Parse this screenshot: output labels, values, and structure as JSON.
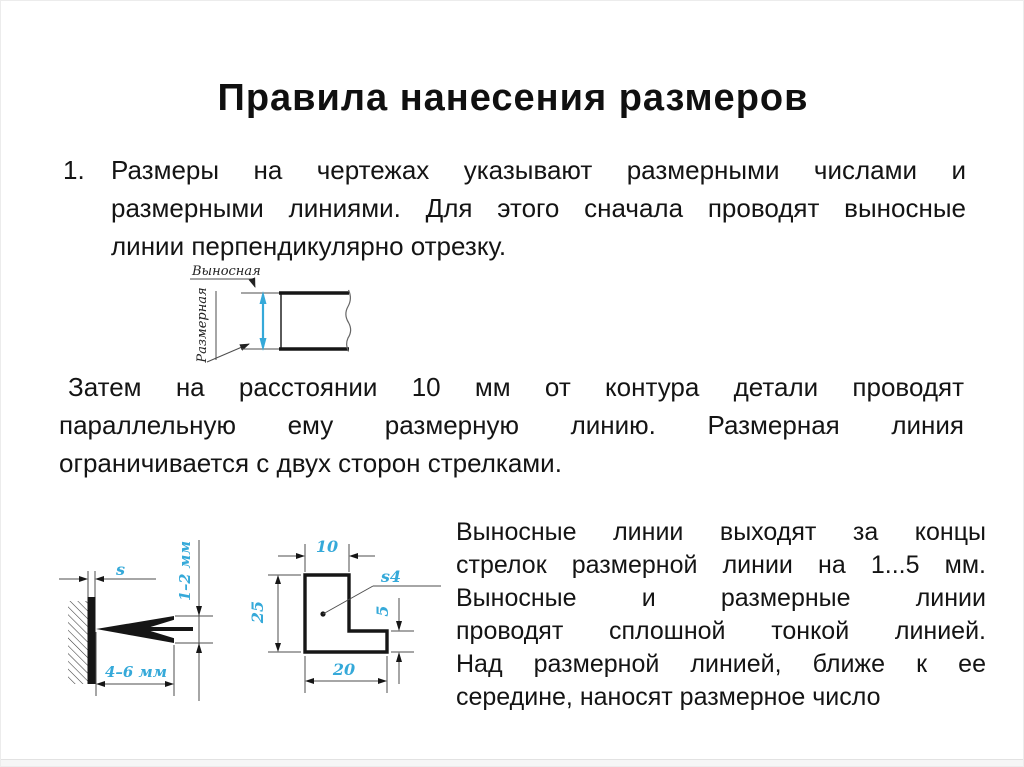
{
  "slide": {
    "title": "Правила нанесения размеров",
    "list_item": {
      "number": "1.",
      "lines": [
        "Размеры на чертежах указывают размерными числами и",
        "размерными линиями. Для этого сначала проводят выносные",
        "линии перпендикулярно отрезку."
      ]
    },
    "paragraph_middle": {
      "lines": [
        "Затем на расстоянии 10 мм от контура детали проводят",
        "параллельную ему размерную линию. Размерная линия",
        "ограничивается с двух сторон стрелками."
      ]
    },
    "paragraph_right": {
      "lines": [
        "Выносные линии выходят за концы",
        "стрелок размерной линии на 1...5 мм.",
        "Выносные и размерные линии",
        "проводят сплошной тонкой линией.",
        "Над размерной линией, ближе к ее",
        "середине, наносят размерное число"
      ]
    }
  },
  "figures": {
    "extension_dimension": {
      "label_extension": "Выносная",
      "label_dimension": "Размерная"
    },
    "arrowhead_detail": {
      "thickness_label": "s",
      "width_label": "1–2 мм",
      "length_label": "4–6 мм"
    },
    "l_part": {
      "dim_top": "10",
      "dim_left": "25",
      "dim_bottom": "20",
      "dim_right": "5",
      "thickness_label": "s4"
    }
  },
  "colors": {
    "dimension_blue": "#35a9d9",
    "line_ink": "#161616"
  }
}
